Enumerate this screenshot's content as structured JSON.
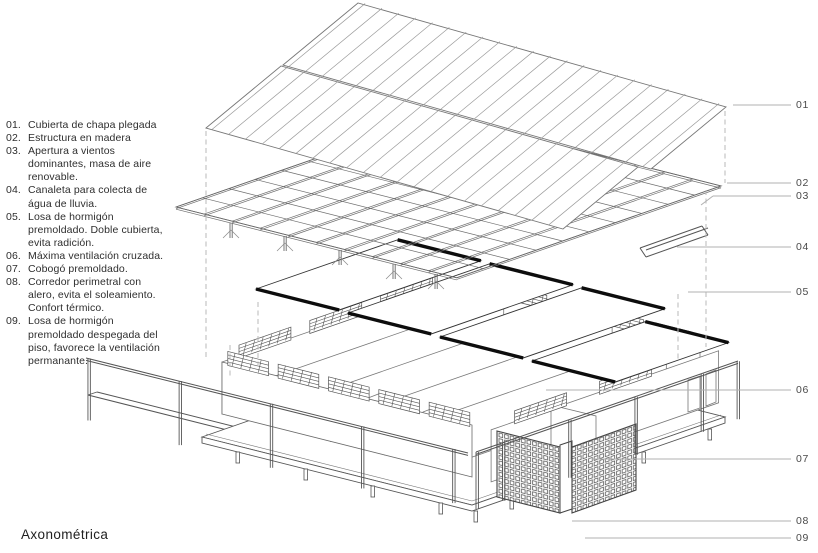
{
  "title": "Axonométrica",
  "legend": {
    "items": [
      {
        "num": "01.",
        "text": "Cubierta de chapa plegada"
      },
      {
        "num": "02.",
        "text": "Estructura en madera"
      },
      {
        "num": "03.",
        "text": "Apertura a vientos dominantes, masa de aire renovable."
      },
      {
        "num": "04.",
        "text": "Canaleta para colecta de água de lluvia."
      },
      {
        "num": "05.",
        "text": "Losa de hormigón premoldado. Doble cubierta, evita radición."
      },
      {
        "num": "06.",
        "text": "Máxima ventilación cruzada."
      },
      {
        "num": "07.",
        "text": "Cobogó premoldado."
      },
      {
        "num": "08.",
        "text": "Corredor perimetral con alero, evita el soleamiento. Confort térmico."
      },
      {
        "num": "09.",
        "text": "Losa de hormigón premoldado despegada del piso, favorece la ventilación permanante."
      }
    ]
  },
  "callouts": [
    {
      "label": "01"
    },
    {
      "label": "02"
    },
    {
      "label": "03"
    },
    {
      "label": "04"
    },
    {
      "label": "05"
    },
    {
      "label": "06"
    },
    {
      "label": "07"
    },
    {
      "label": "08"
    },
    {
      "label": "09"
    }
  ],
  "colors": {
    "background": "#ffffff",
    "ink": "#555555",
    "slab_edge": "#111111",
    "leader": "#b0b0b0"
  }
}
